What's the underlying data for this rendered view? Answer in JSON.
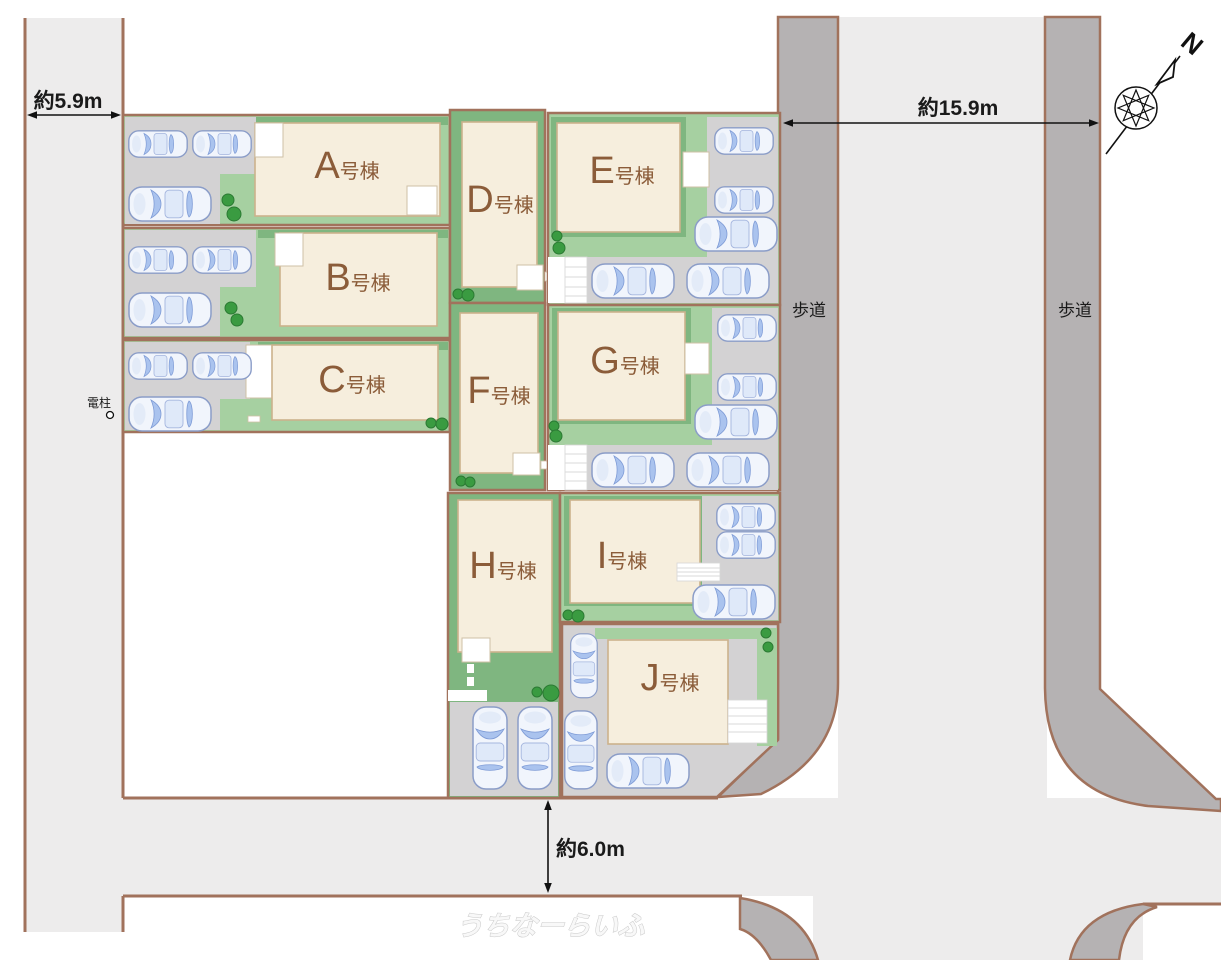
{
  "title": "分譲地区画図",
  "buildings": [
    {
      "id": "A",
      "letter": "A",
      "suffix": "号棟"
    },
    {
      "id": "B",
      "letter": "B",
      "suffix": "号棟"
    },
    {
      "id": "C",
      "letter": "C",
      "suffix": "号棟"
    },
    {
      "id": "D",
      "letter": "D",
      "suffix": "号棟"
    },
    {
      "id": "E",
      "letter": "E",
      "suffix": "号棟"
    },
    {
      "id": "F",
      "letter": "F",
      "suffix": "号棟"
    },
    {
      "id": "G",
      "letter": "G",
      "suffix": "号棟"
    },
    {
      "id": "H",
      "letter": "H",
      "suffix": "号棟"
    },
    {
      "id": "I",
      "letter": "I",
      "suffix": "号棟"
    },
    {
      "id": "J",
      "letter": "J",
      "suffix": "号棟"
    }
  ],
  "measurements": {
    "road_left_width": "約5.9m",
    "road_right_width": "約15.9m",
    "road_bottom_width": "約6.0m"
  },
  "road_labels": {
    "sidewalk_left": "歩道",
    "sidewalk_right": "歩道"
  },
  "utility_pole_label": "電柱",
  "compass_label": "N",
  "watermark": "うちなーらいふ",
  "colors": {
    "road": "#edecec",
    "sidewalk": "#b5b2b3",
    "border": "#a1725c",
    "parking": "#d3d2d3",
    "lawn_light": "#a6d0a1",
    "lawn_dark": "#7fb680",
    "building": "#f6eedd",
    "building_border": "#ccb28c",
    "label": "#8b5c39",
    "tree": "#3a9b41",
    "tree_border": "#2b7a33",
    "car_body": "#f1f5fc",
    "car_glass": "#aac3ee",
    "car_stroke": "#8b9dc8",
    "ink": "#1a1a1a",
    "watermark": "#f8f8f8"
  }
}
